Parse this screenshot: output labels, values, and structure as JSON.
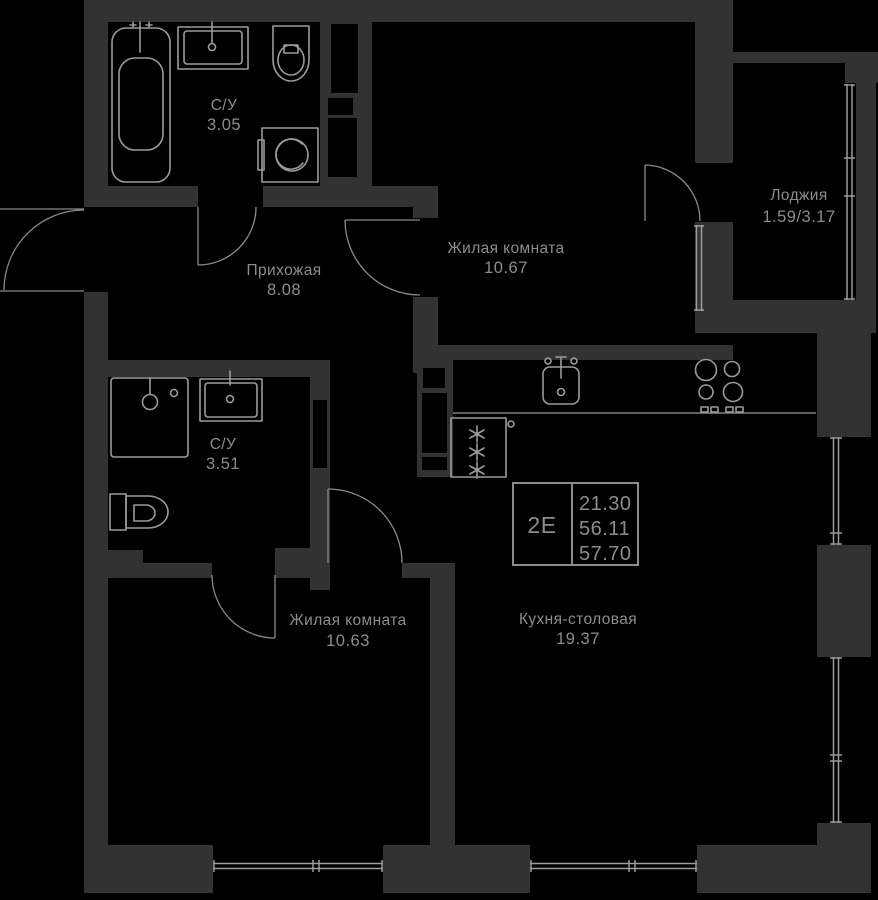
{
  "plan_title": "Floor plan 2E apartment",
  "colors": {
    "background": "#000000",
    "wall": "#323232",
    "fixture_line": "#9b9b9b",
    "text": "#8c8c8c"
  },
  "rooms": {
    "bath1": {
      "label": "С/У",
      "area": "3.05"
    },
    "hallway": {
      "label": "Прихожая",
      "area": "8.08"
    },
    "living1": {
      "label": "Жилая комната",
      "area": "10.67"
    },
    "loggia": {
      "label": "Лоджия",
      "area": "1.59/3.17"
    },
    "bath2": {
      "label": "С/У",
      "area": "3.51"
    },
    "living2": {
      "label": "Жилая комната",
      "area": "10.63"
    },
    "kitchen": {
      "label": "Кухня-столовая",
      "area": "19.37"
    }
  },
  "stamp": {
    "flat_type": "2Е",
    "values": [
      "21.30",
      "56.11",
      "57.70"
    ]
  }
}
